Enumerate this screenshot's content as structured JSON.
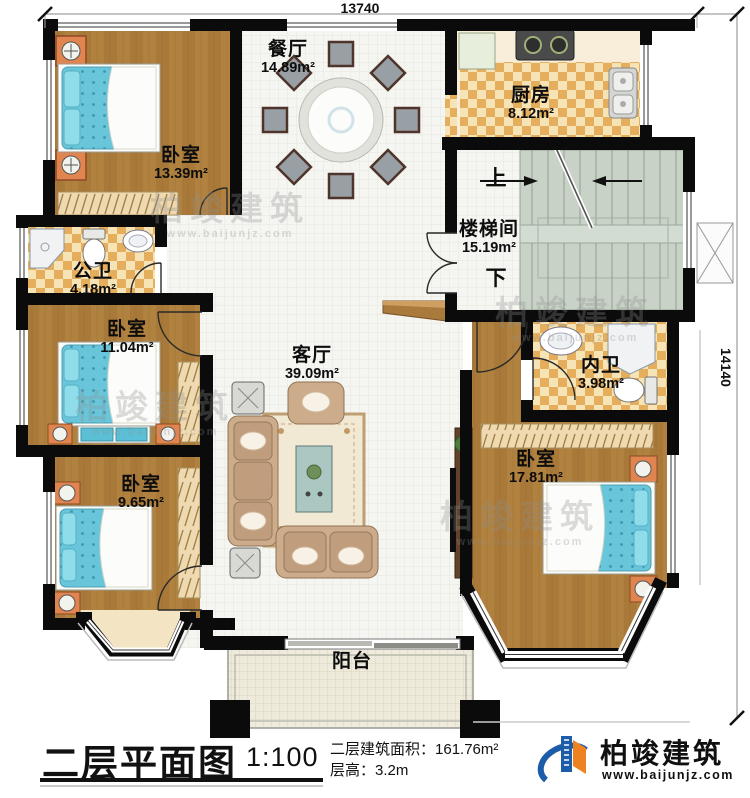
{
  "page": {
    "dim_top": "13740",
    "dim_right": "14140"
  },
  "rooms": {
    "bedroom_tl": {
      "name": "卧室",
      "area": "13.39m²"
    },
    "dining": {
      "name": "餐厅",
      "area": "14.89m²"
    },
    "kitchen": {
      "name": "厨房",
      "area": "8.12m²"
    },
    "stairwell": {
      "name": "楼梯间",
      "area": "15.19m²",
      "up": "上",
      "down": "下"
    },
    "bath_public": {
      "name": "公卫",
      "area": "4.18m²"
    },
    "bedroom_ml": {
      "name": "卧室",
      "area": "11.04m²"
    },
    "living": {
      "name": "客厅",
      "area": "39.09m²"
    },
    "bath_inner": {
      "name": "内卫",
      "area": "3.98m²"
    },
    "bedroom_br": {
      "name": "卧室",
      "area": "17.81m²"
    },
    "bedroom_bl": {
      "name": "卧室",
      "area": "9.65m²"
    },
    "balcony": {
      "name": "阳台"
    }
  },
  "titleblock": {
    "title": "二层平面图",
    "scale": "1:100",
    "area_label": "二层建筑面积：",
    "area_value": "161.76m²",
    "height_label": "层高：",
    "height_value": "3.2m"
  },
  "logo": {
    "name": "柏竣建筑",
    "website": "www.baijunjz.com"
  },
  "watermark": {
    "text": "柏竣建筑",
    "website": "www.baijunjz.com"
  },
  "colors": {
    "wall": "#0b0b0b",
    "wood": "#b1823f",
    "tile": "#f5f5f2",
    "checker": "#e5ae5c",
    "stair": "#c8d2c7",
    "bed_blue": "#69c6da",
    "nightstand_orange": "#e08550",
    "logo_blue": "#1c5ca9",
    "logo_orange": "#ef8220"
  }
}
